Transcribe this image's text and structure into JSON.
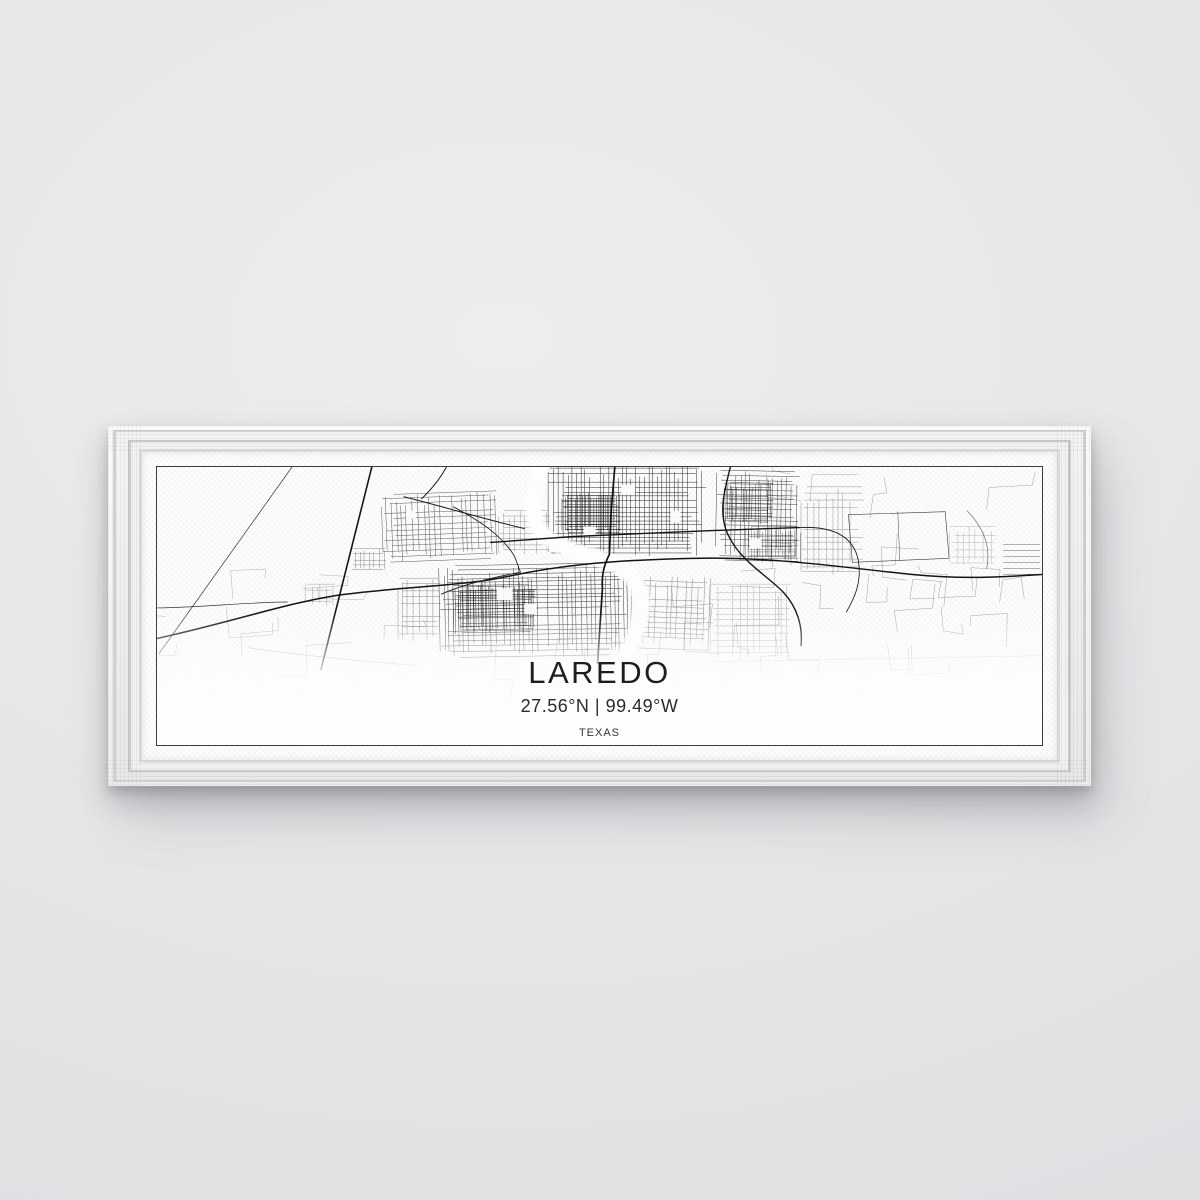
{
  "wall_art": {
    "title": "LAREDO",
    "coordinates": "27.56°N | 99.49°W",
    "region_label": "TEXAS"
  },
  "colors": {
    "wall": "#e7e7e9",
    "frame_white": "#f2f2f1",
    "canvas_white": "#fdfdfd",
    "map_ink": "#161616",
    "printed_border_line": "#3c3c3c"
  }
}
